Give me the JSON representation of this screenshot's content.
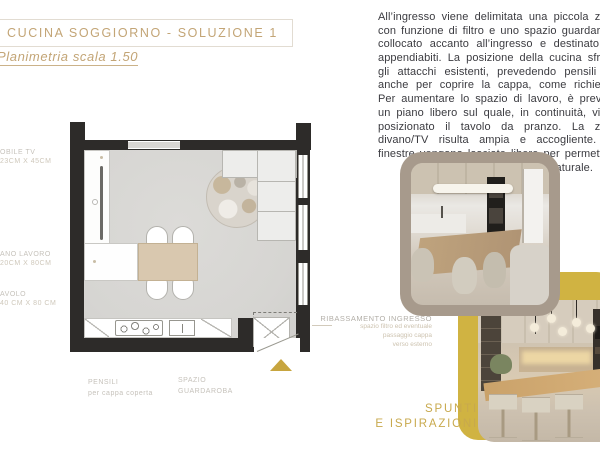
{
  "header": {
    "title": "CUCINA SOGGIORNO - SOLUZIONE 1",
    "subtitle": "Planimetria scala 1.50"
  },
  "description": "All’ingresso viene delimitata una piccola zona con funzione di filtro e uno spazio guardaroba collocato accanto all’ingresso e destinato ad appendiabiti. La posizione della cucina sfrutta gli attacchi esistenti, prevedendo pensili alti anche per coprire la cappa, come richiesto. Per aumentare lo spazio di lavoro, è previsto un piano libero sul quale, in continuità, viene posizionato il tavolo da pranzo. La zona divano/TV risulta ampia e accogliente. Le finestre vengono lasciate libere per permettere il massimo ingresso di luce naturale.",
  "plan": {
    "labels": {
      "mobile_tv": {
        "line1": "OBILE TV",
        "line2": "23CM X 45CM"
      },
      "piano_lavoro": {
        "line1": "ANO LAVORO",
        "line2": "20CM X 80CM"
      },
      "tavolo": {
        "line1": "AVOLO",
        "line2": "40 CM X 80 CM"
      },
      "pensili": {
        "line1": "PENSILI",
        "line2": "per cappa coperta"
      },
      "guardaroba": {
        "line1": "SPAZIO",
        "line2": "GUARDAROBA"
      },
      "ribassamento": {
        "line1": "RIBASSAMENTO INGRESSO",
        "line2": "spazio filtro ed eventuale",
        "line3": "passaggio cappa",
        "line4": "verso esterno"
      }
    }
  },
  "inspiration": {
    "label_line1": "SPUNTI",
    "label_line2": "E ISPIRAZIONI"
  },
  "colors": {
    "accent_gold": "#c3a576",
    "mustard": "#d0b342",
    "taupe_frame": "#a79a8c",
    "wall": "#2d2b29",
    "floor": "#d6d5d2",
    "wood": "#d9c8af",
    "body_text": "#3b3b40"
  }
}
